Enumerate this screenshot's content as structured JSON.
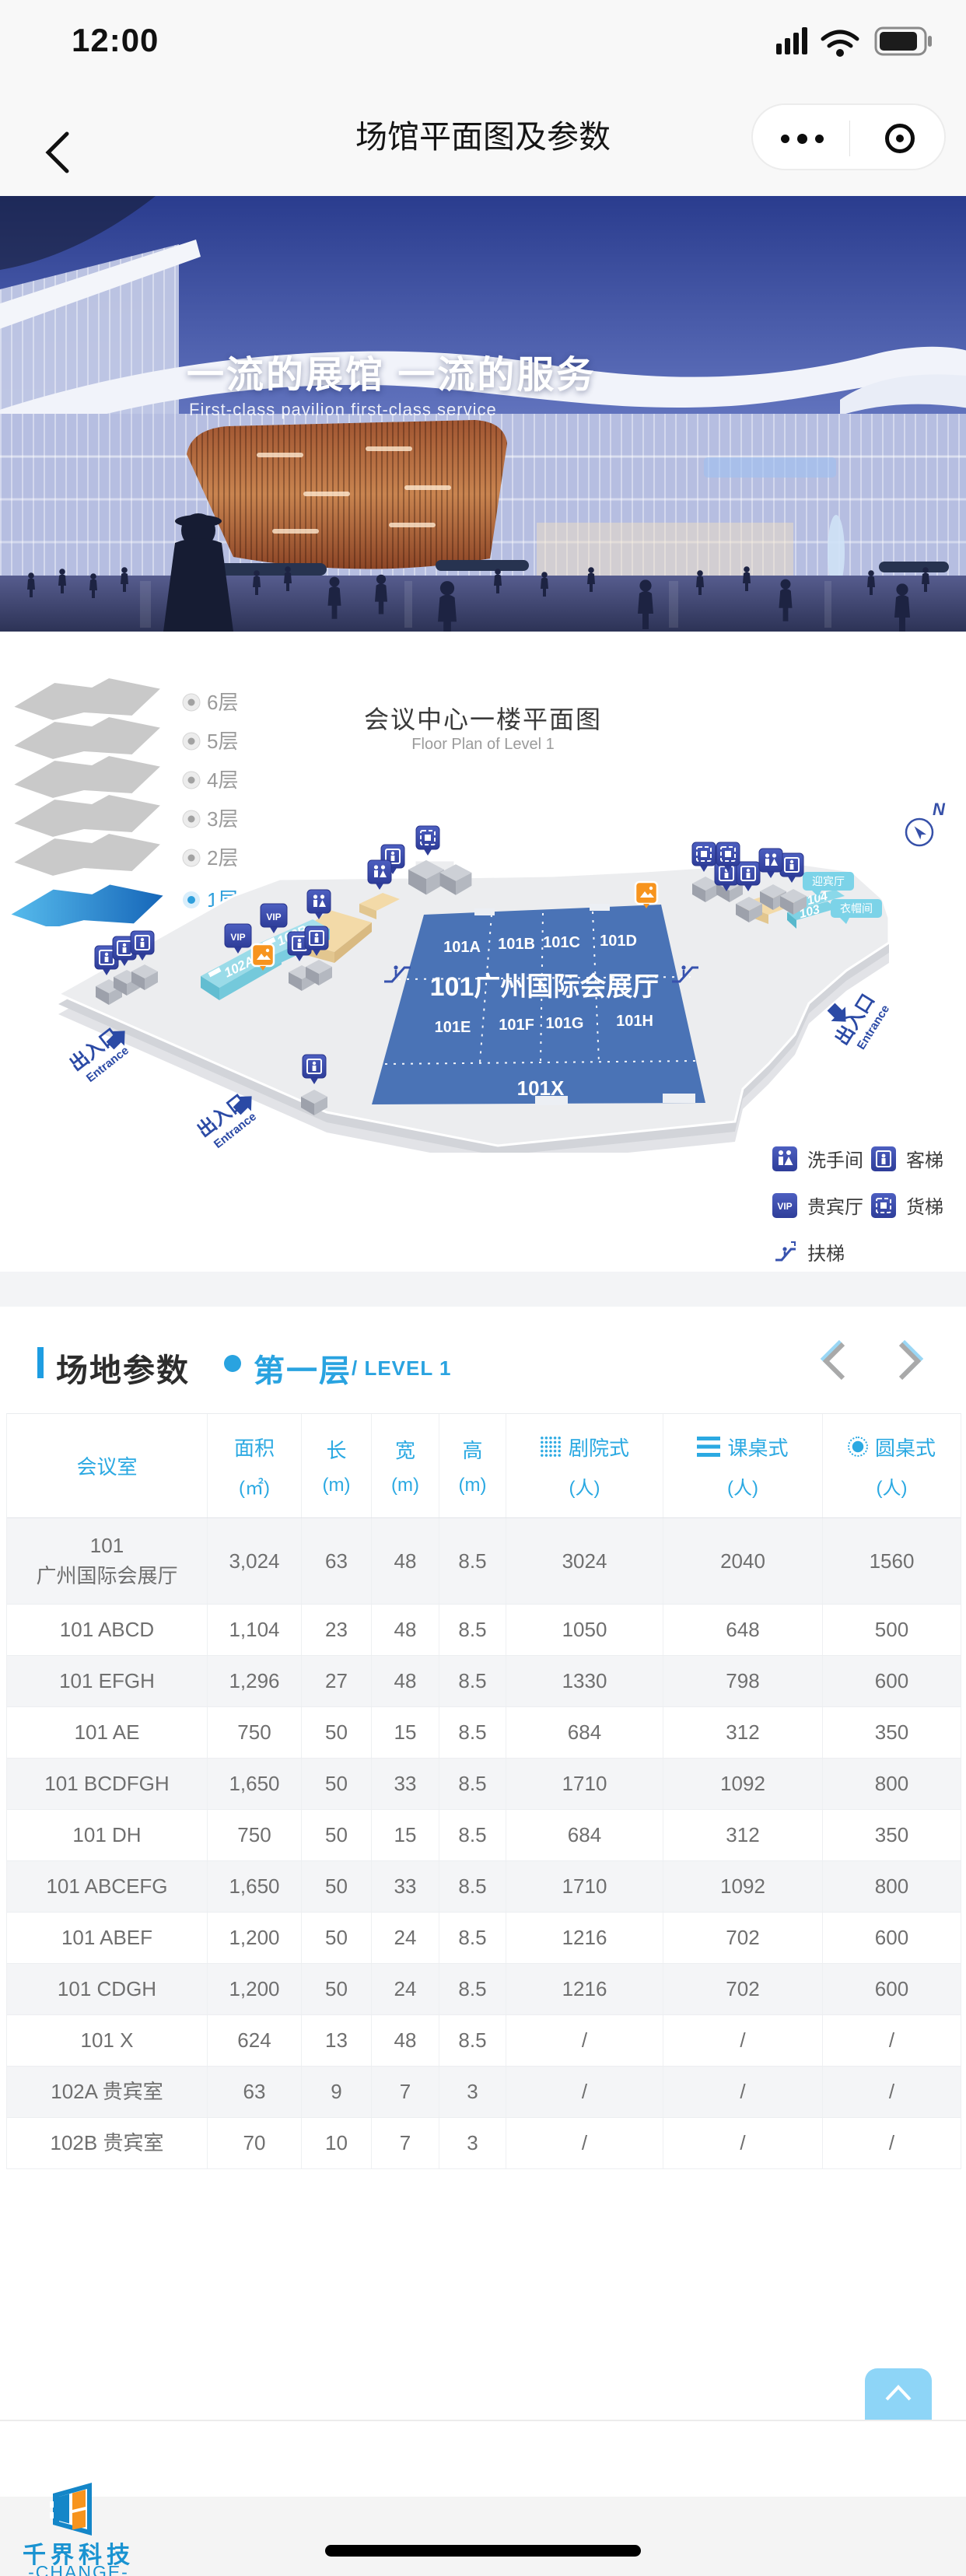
{
  "status_bar": {
    "time": "12:00"
  },
  "nav": {
    "title": "场馆平面图及参数"
  },
  "hero": {
    "title": "一流的展馆  一流的服务",
    "subtitle": "First-class pavilion first-class service"
  },
  "floor_section": {
    "title": "会议中心一楼平面图",
    "subtitle": "Floor Plan of Level 1",
    "floors": [
      {
        "label": "6层"
      },
      {
        "label": "5层"
      },
      {
        "label": "4层"
      },
      {
        "label": "3层"
      },
      {
        "label": "2层"
      },
      {
        "label": "1层"
      }
    ],
    "plan": {
      "hall_title": "101广州国际会展厅",
      "rooms_row1": [
        "101A",
        "101B",
        "101C",
        "101D"
      ],
      "rooms_row2": [
        "101E",
        "101F",
        "101G",
        "101H"
      ],
      "room_x": "101X",
      "room_102a": "102A",
      "room_102b": "102B",
      "room_103": "103",
      "room_104": "104",
      "bubble_welcome": "迎宾厅",
      "bubble_cloak": "衣帽间",
      "vip": "VIP",
      "entrance_cn": "出入口",
      "entrance_en": "Entrance",
      "compass": "N"
    },
    "legend": [
      {
        "label": "洗手间"
      },
      {
        "label": "客梯"
      },
      {
        "label": "贵宾厅"
      },
      {
        "label": "货梯"
      },
      {
        "label": "扶梯"
      }
    ]
  },
  "params": {
    "section_title": "场地参数",
    "floor_label": "第一层",
    "floor_suffix": "/ LEVEL 1",
    "table": {
      "room_header": "会议室",
      "columns": [
        {
          "label": "面积",
          "unit": "(㎡)"
        },
        {
          "label": "长",
          "unit": "(m)"
        },
        {
          "label": "宽",
          "unit": "(m)"
        },
        {
          "label": "高",
          "unit": "(m)"
        },
        {
          "label": "剧院式",
          "unit": "(人)"
        },
        {
          "label": "课桌式",
          "unit": "(人)"
        },
        {
          "label": "圆桌式",
          "unit": "(人)"
        }
      ],
      "rows": [
        {
          "cells": [
            "101\n广州国际会展厅",
            "3,024",
            "63",
            "48",
            "8.5",
            "3024",
            "2040",
            "1560"
          ]
        },
        {
          "cells": [
            "101 ABCD",
            "1,104",
            "23",
            "48",
            "8.5",
            "1050",
            "648",
            "500"
          ]
        },
        {
          "cells": [
            "101 EFGH",
            "1,296",
            "27",
            "48",
            "8.5",
            "1330",
            "798",
            "600"
          ]
        },
        {
          "cells": [
            "101 AE",
            "750",
            "50",
            "15",
            "8.5",
            "684",
            "312",
            "350"
          ]
        },
        {
          "cells": [
            "101 BCDFGH",
            "1,650",
            "50",
            "33",
            "8.5",
            "1710",
            "1092",
            "800"
          ]
        },
        {
          "cells": [
            "101 DH",
            "750",
            "50",
            "15",
            "8.5",
            "684",
            "312",
            "350"
          ]
        },
        {
          "cells": [
            "101 ABCEFG",
            "1,650",
            "50",
            "33",
            "8.5",
            "1710",
            "1092",
            "800"
          ]
        },
        {
          "cells": [
            "101 ABEF",
            "1,200",
            "50",
            "24",
            "8.5",
            "1216",
            "702",
            "600"
          ]
        },
        {
          "cells": [
            "101 CDGH",
            "1,200",
            "50",
            "24",
            "8.5",
            "1216",
            "702",
            "600"
          ]
        },
        {
          "cells": [
            "101 X",
            "624",
            "13",
            "48",
            "8.5",
            "/",
            "/",
            "/"
          ]
        },
        {
          "cells": [
            "102A 贵宾室",
            "63",
            "9",
            "7",
            "3",
            "/",
            "/",
            "/"
          ]
        },
        {
          "cells": [
            "102B 贵宾室",
            "70",
            "10",
            "7",
            "3",
            "/",
            "/",
            "/"
          ]
        }
      ]
    }
  },
  "footer": {
    "logo_cn": "千界科技",
    "logo_en": "-CHANGE-"
  },
  "colors": {
    "accent_blue": "#29a3e0",
    "table_header_blue": "#2ba9e2",
    "hall_blue": "#4a73b6",
    "pin_indigo": "#36459c",
    "active_floor_blue": "#1f86cf",
    "back_top_blue": "#8ed5f7",
    "logo_blue": "#1a93d1",
    "logo_orange": "#f7941e"
  }
}
